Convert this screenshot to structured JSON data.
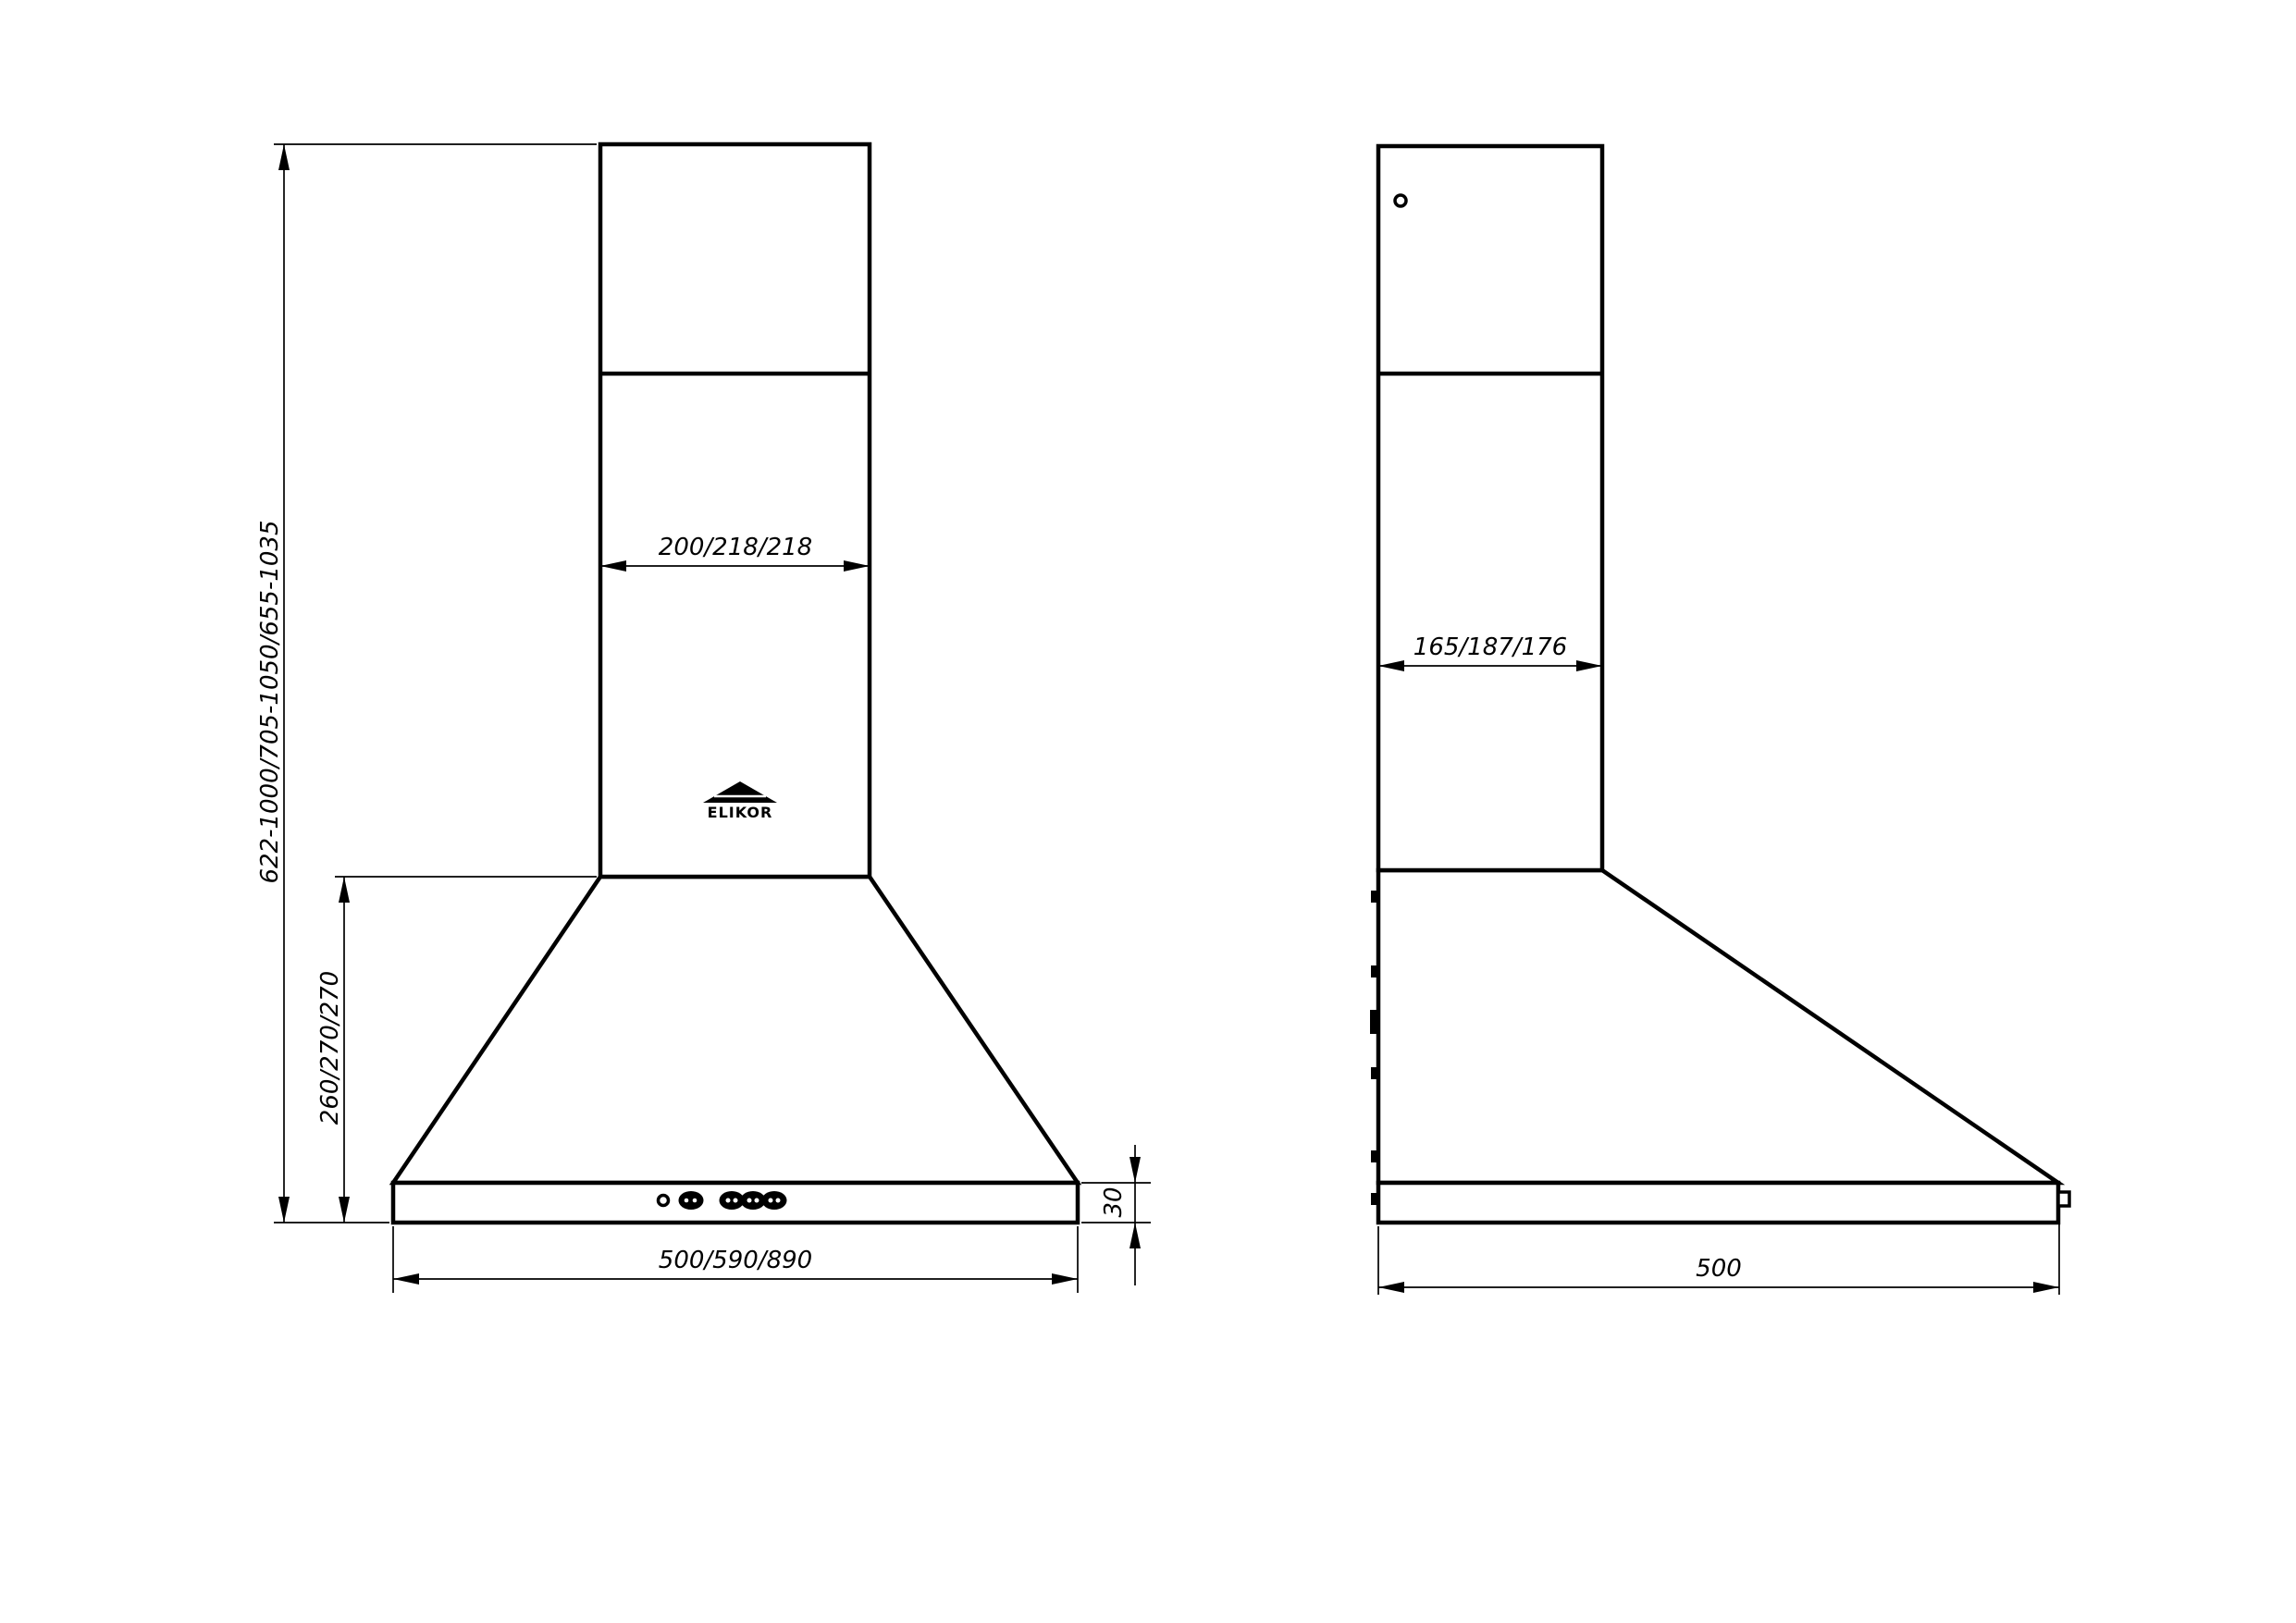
{
  "front_view": {
    "overall_height": "622-1000/705-1050/655-1035",
    "body_height": "260/270/270",
    "chimney_width": "200/218/218",
    "body_width": "500/590/890",
    "base_height": "30",
    "logo_text": "ELIKOR"
  },
  "side_view": {
    "chimney_depth": "165/187/176",
    "body_depth": "500"
  },
  "colors": {
    "line": "#000000",
    "background": "#ffffff"
  }
}
